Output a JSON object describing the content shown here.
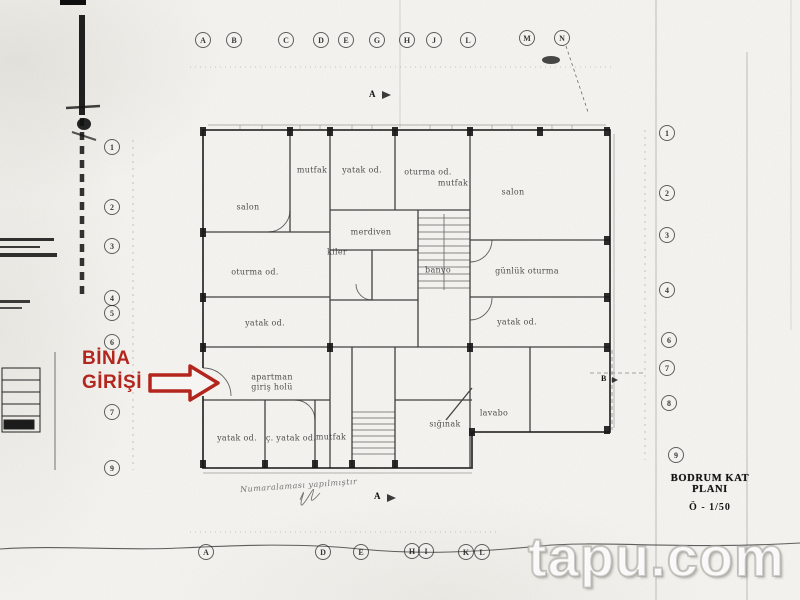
{
  "document": {
    "plan_title": "BODRUM KAT PLANI",
    "plan_scale": "Ö - 1/50",
    "watermark": "tapu.com",
    "entrance_label_line1": "BİNA",
    "entrance_label_line2": "GİRİŞİ",
    "handwritten_note": "Numaralaması yapılmıştır",
    "section_marker_top": "A",
    "section_marker_bottom": "A",
    "section_marker_right": "B"
  },
  "colors": {
    "annotation_red": "#b3261e",
    "ink": "#1f1f1f",
    "paper": "#f7f6f2",
    "watermark_outline": "#a5a29b"
  },
  "grid_labels": {
    "top": [
      {
        "label": "A",
        "x": 203,
        "y": 40
      },
      {
        "label": "B",
        "x": 234,
        "y": 40
      },
      {
        "label": "C",
        "x": 286,
        "y": 40
      },
      {
        "label": "D",
        "x": 321,
        "y": 40
      },
      {
        "label": "E",
        "x": 346,
        "y": 40
      },
      {
        "label": "G",
        "x": 377,
        "y": 40
      },
      {
        "label": "H",
        "x": 407,
        "y": 40
      },
      {
        "label": "J",
        "x": 434,
        "y": 40
      },
      {
        "label": "L",
        "x": 468,
        "y": 40
      },
      {
        "label": "M",
        "x": 527,
        "y": 38
      },
      {
        "label": "N",
        "x": 562,
        "y": 38
      }
    ],
    "bottom": [
      {
        "label": "A",
        "x": 206,
        "y": 552
      },
      {
        "label": "D",
        "x": 323,
        "y": 552
      },
      {
        "label": "E",
        "x": 361,
        "y": 552
      },
      {
        "label": "H",
        "x": 412,
        "y": 551
      },
      {
        "label": "I",
        "x": 426,
        "y": 551
      },
      {
        "label": "K",
        "x": 466,
        "y": 552
      },
      {
        "label": "L",
        "x": 482,
        "y": 552
      }
    ],
    "left": [
      {
        "label": "1",
        "x": 112,
        "y": 147
      },
      {
        "label": "2",
        "x": 112,
        "y": 207
      },
      {
        "label": "3",
        "x": 112,
        "y": 246
      },
      {
        "label": "4",
        "x": 112,
        "y": 298
      },
      {
        "label": "5",
        "x": 112,
        "y": 313
      },
      {
        "label": "6",
        "x": 112,
        "y": 342
      },
      {
        "label": "7",
        "x": 112,
        "y": 412
      },
      {
        "label": "9",
        "x": 112,
        "y": 468
      }
    ],
    "right": [
      {
        "label": "1",
        "x": 667,
        "y": 133
      },
      {
        "label": "2",
        "x": 667,
        "y": 193
      },
      {
        "label": "3",
        "x": 667,
        "y": 235
      },
      {
        "label": "4",
        "x": 667,
        "y": 290
      },
      {
        "label": "6",
        "x": 669,
        "y": 340
      },
      {
        "label": "7",
        "x": 667,
        "y": 368
      },
      {
        "label": "8",
        "x": 669,
        "y": 403
      },
      {
        "label": "9",
        "x": 676,
        "y": 455
      }
    ]
  },
  "room_labels": [
    {
      "label": "salon",
      "x": 248,
      "y": 207
    },
    {
      "label": "mutfak",
      "x": 312,
      "y": 170
    },
    {
      "label": "yatak od.",
      "x": 362,
      "y": 170
    },
    {
      "label": "oturma od.",
      "x": 428,
      "y": 172
    },
    {
      "label": "mutfak",
      "x": 453,
      "y": 183
    },
    {
      "label": "salon",
      "x": 513,
      "y": 192
    },
    {
      "label": "kiler",
      "x": 337,
      "y": 252
    },
    {
      "label": "oturma od.",
      "x": 255,
      "y": 272
    },
    {
      "label": "yatak od.",
      "x": 265,
      "y": 323
    },
    {
      "label": "banyo",
      "x": 438,
      "y": 270
    },
    {
      "label": "merdiven",
      "x": 371,
      "y": 232
    },
    {
      "label": "günlük oturma",
      "x": 527,
      "y": 271
    },
    {
      "label": "yatak od.",
      "x": 517,
      "y": 322
    },
    {
      "label": "apartman",
      "x": 272,
      "y": 377
    },
    {
      "label": "giriş holü",
      "x": 272,
      "y": 387
    },
    {
      "label": "yatak od.",
      "x": 237,
      "y": 438
    },
    {
      "label": "ç. yatak od.",
      "x": 291,
      "y": 438
    },
    {
      "label": "mutfak",
      "x": 331,
      "y": 437
    },
    {
      "label": "sığınak",
      "x": 445,
      "y": 424
    },
    {
      "label": "lavabo",
      "x": 494,
      "y": 413
    }
  ]
}
